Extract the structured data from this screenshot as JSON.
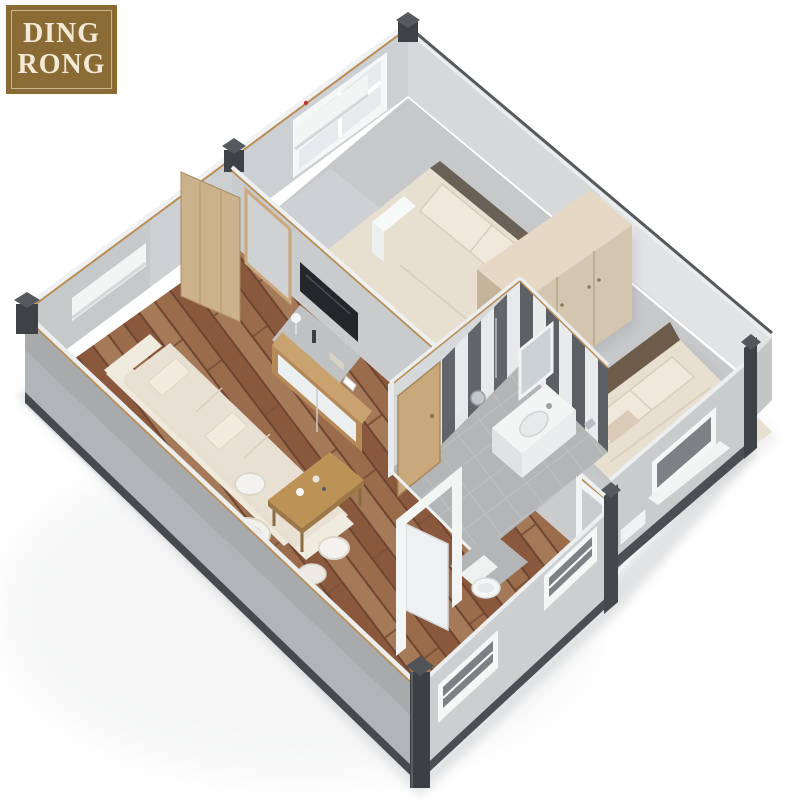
{
  "logo": {
    "line1": "DING",
    "line2": "RONG"
  },
  "palette": {
    "bg": "#ffffff",
    "logo_bg": "#8a6a35",
    "logo_border": "#c9b68c",
    "logo_text": "#f3ead6",
    "ground_shadow": "#d9dadc",
    "wall_inner": "#d6d8da",
    "wall_inner_warm": "#cdd0d2",
    "wall_outer": "#b2b5b7",
    "wall_front": "#ccced0",
    "wall_front_b": "#c9cbcd",
    "rail_dark": "#4b4e52",
    "post_dark": "#3e4145",
    "trim_tan": "#b98e57",
    "top_light": "#eceded",
    "wood_base": "#946447",
    "wood_seam": "#6e4530",
    "gray_floor": "#c6c8ca",
    "tile_gray": "#b3b5b7",
    "bed_cream": "#e7dfd0",
    "bed_shadow": "#d6cbb8",
    "pillow": "#efe8db",
    "headboard1": "#6a6156",
    "headboard2": "#6e5c4b",
    "wardrobe_front": "#d4c5ae",
    "wardrobe_top": "#e5d8c4",
    "wardrobe_side": "#c4b49c",
    "stripe_dark": "#5c6065",
    "stripe_light": "#e9eaeb",
    "white_fixture": "#f3f5f5",
    "door_tan": "#c9a87b",
    "leaf_tan": "#ccb28c",
    "tv_dark": "#24272a",
    "cabinet_wood": "#b68a58",
    "table_wood": "#bc9257",
    "sofa": "#e8e1d3",
    "glass": "#7d8185",
    "window_frame": "#f5f6f6",
    "red_dot": "#c0392b"
  }
}
